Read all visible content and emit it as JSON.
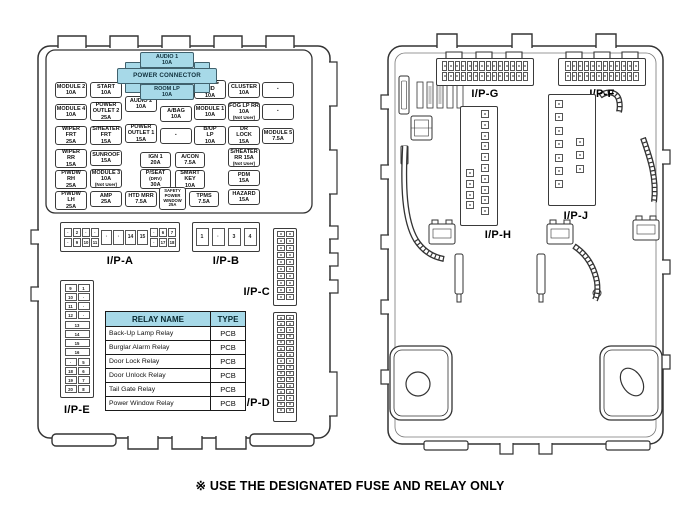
{
  "window": {
    "caption": "※ USE THE DESIGNATED FUSE AND RELAY ONLY"
  },
  "colors": {
    "highlight": "#a7d9e8",
    "line": "#333333"
  },
  "power_connector": {
    "label": "POWER CONNECTOR",
    "top_fuse": {
      "lines": [
        "AUDIO 1",
        "10A"
      ]
    },
    "bottom_fuse": {
      "lines": [
        "ROOM LP",
        "10A"
      ]
    }
  },
  "fuse_panel": {
    "fuses": [
      {
        "lines": [
          "MODULE 2",
          "10A"
        ],
        "x": 55,
        "y": 82,
        "w": 32,
        "h": 16
      },
      {
        "lines": [
          "START",
          "10A"
        ],
        "x": 90,
        "y": 82,
        "w": 32,
        "h": 16
      },
      {
        "lines": [
          "A/BAG",
          "IND",
          "10A"
        ],
        "x": 194,
        "y": 80,
        "w": 32,
        "h": 19
      },
      {
        "lines": [
          "CLUSTER",
          "10A"
        ],
        "x": 228,
        "y": 82,
        "w": 32,
        "h": 16
      },
      {
        "blank": true,
        "lines": [
          "·"
        ],
        "x": 262,
        "y": 82,
        "w": 32,
        "h": 16
      },
      {
        "lines": [
          "MODULE 4",
          "10A"
        ],
        "x": 55,
        "y": 104,
        "w": 32,
        "h": 16
      },
      {
        "lines": [
          "POWER",
          "OUTLET 2",
          "25A"
        ],
        "x": 90,
        "y": 102,
        "w": 32,
        "h": 19
      },
      {
        "lines": [
          "AUDIO 2",
          "10A"
        ],
        "x": 125,
        "y": 96,
        "w": 32,
        "h": 16
      },
      {
        "lines": [
          "A/BAG",
          "10A"
        ],
        "x": 160,
        "y": 106,
        "w": 32,
        "h": 16
      },
      {
        "lines": [
          "MODULE 1",
          "10A"
        ],
        "x": 194,
        "y": 104,
        "w": 32,
        "h": 16
      },
      {
        "lines": [
          "FOG LP RR",
          "10A",
          "(Not User)"
        ],
        "x": 228,
        "y": 102,
        "w": 32,
        "h": 19
      },
      {
        "blank": true,
        "lines": [
          "·"
        ],
        "x": 262,
        "y": 104,
        "w": 32,
        "h": 16
      },
      {
        "lines": [
          "WIPER",
          "FRT",
          "25A"
        ],
        "x": 55,
        "y": 126,
        "w": 32,
        "h": 19
      },
      {
        "lines": [
          "S/HEATER",
          "FRT",
          "15A"
        ],
        "x": 90,
        "y": 126,
        "w": 32,
        "h": 19
      },
      {
        "lines": [
          "POWER",
          "OUTLET 1",
          "15A"
        ],
        "x": 125,
        "y": 124,
        "w": 32,
        "h": 19
      },
      {
        "blank": true,
        "lines": [
          "·"
        ],
        "x": 160,
        "y": 128,
        "w": 32,
        "h": 16
      },
      {
        "lines": [
          "B/UP",
          "LP",
          "10A"
        ],
        "x": 194,
        "y": 126,
        "w": 32,
        "h": 19
      },
      {
        "lines": [
          "DR",
          "LOCK",
          "15A"
        ],
        "x": 228,
        "y": 126,
        "w": 32,
        "h": 19
      },
      {
        "lines": [
          "MODULE 5",
          "7.5A"
        ],
        "x": 262,
        "y": 128,
        "w": 32,
        "h": 16
      },
      {
        "lines": [
          "WIPER",
          "RR",
          "15A"
        ],
        "x": 55,
        "y": 149,
        "w": 32,
        "h": 19
      },
      {
        "lines": [
          "SUNROOF",
          "15A"
        ],
        "x": 90,
        "y": 150,
        "w": 32,
        "h": 16
      },
      {
        "lines": [
          "IGN 1",
          "20A"
        ],
        "x": 140,
        "y": 152,
        "w": 31,
        "h": 16
      },
      {
        "lines": [
          "A/CON",
          "7.5A"
        ],
        "x": 175,
        "y": 152,
        "w": 30,
        "h": 16
      },
      {
        "lines": [
          "S/HEATER",
          "RR 15A",
          "(Not User)"
        ],
        "x": 228,
        "y": 148,
        "w": 32,
        "h": 19
      },
      {
        "lines": [
          "P/WDW",
          "RH",
          "25A"
        ],
        "x": 55,
        "y": 170,
        "w": 32,
        "h": 19
      },
      {
        "lines": [
          "MODULE 3",
          "10A",
          "(Not User)"
        ],
        "x": 90,
        "y": 169,
        "w": 32,
        "h": 19
      },
      {
        "lines": [
          "P/SEAT",
          "(DRV)",
          "30A"
        ],
        "x": 140,
        "y": 169,
        "w": 31,
        "h": 20
      },
      {
        "lines": [
          "SMART",
          "KEY",
          "10A"
        ],
        "x": 175,
        "y": 170,
        "w": 30,
        "h": 19
      },
      {
        "lines": [
          "PDM",
          "15A"
        ],
        "x": 228,
        "y": 170,
        "w": 32,
        "h": 16
      },
      {
        "lines": [
          "P/WDW",
          "LH",
          "25A"
        ],
        "x": 55,
        "y": 191,
        "w": 32,
        "h": 19
      },
      {
        "lines": [
          "AMP",
          "25A"
        ],
        "x": 90,
        "y": 191,
        "w": 32,
        "h": 16
      },
      {
        "lines": [
          "HTD MRR",
          "7.5A"
        ],
        "x": 125,
        "y": 191,
        "w": 32,
        "h": 16
      },
      {
        "small": true,
        "lines": [
          "SAFETY",
          "POWER",
          "WINDOW",
          "25A"
        ],
        "x": 159,
        "y": 187,
        "w": 27,
        "h": 23
      },
      {
        "lines": [
          "TPMS",
          "7.5A"
        ],
        "x": 189,
        "y": 191,
        "w": 30,
        "h": 16
      },
      {
        "lines": [
          "HAZARD",
          "15A"
        ],
        "x": 228,
        "y": 189,
        "w": 32,
        "h": 16
      }
    ]
  },
  "relay_table": {
    "headers": [
      "RELAY NAME",
      "TYPE"
    ],
    "rows": [
      [
        "Back-Up Lamp Relay",
        "PCB"
      ],
      [
        "Burglar Alarm Relay",
        "PCB"
      ],
      [
        "Door Lock Relay",
        "PCB"
      ],
      [
        "Door Unlock Relay",
        "PCB"
      ],
      [
        "Tail Gate Relay",
        "PCB"
      ],
      [
        "Power Window Relay",
        "PCB"
      ]
    ]
  },
  "connectors": {
    "ipa": {
      "label": "I/P-A",
      "left_top": [
        "·",
        "2",
        "·",
        "·"
      ],
      "left_bottom": [
        "·",
        "9",
        "10",
        "11"
      ],
      "middle": [
        "·",
        "·",
        "14",
        "15"
      ],
      "right_top": [
        "·",
        "6",
        "7"
      ],
      "right_bottom": [
        "·",
        "17",
        "18"
      ]
    },
    "ipb": {
      "label": "I/P-B",
      "cells": [
        "1",
        "·",
        "3",
        "4"
      ]
    },
    "ipc": {
      "label": "I/P-C",
      "rows": 10,
      "cols": 2
    },
    "ipd": {
      "label": "I/P-D",
      "rows": 16,
      "cols": 2
    },
    "ipe": {
      "label": "I/P-E",
      "top_pairs": [
        [
          "9",
          "1"
        ],
        [
          "10",
          "·"
        ],
        [
          "11",
          "·"
        ],
        [
          "12",
          "·"
        ]
      ],
      "middle": [
        "13",
        "14",
        "15",
        "16"
      ],
      "bottom_pairs": [
        [
          "·",
          "5"
        ],
        [
          "18",
          "6"
        ],
        [
          "19",
          "7"
        ],
        [
          "20",
          "8"
        ]
      ]
    },
    "ipg": {
      "label": "I/P-G",
      "rows": 2,
      "cols": 14
    },
    "ipf": {
      "label": "I/P-F",
      "rows": 2,
      "cols": 12
    },
    "iph": {
      "label": "I/P-H",
      "right_pins": 10,
      "left_pins": 4
    },
    "ipj": {
      "label": "I/P-J",
      "left_pins": 7,
      "right_pins": 3
    }
  }
}
